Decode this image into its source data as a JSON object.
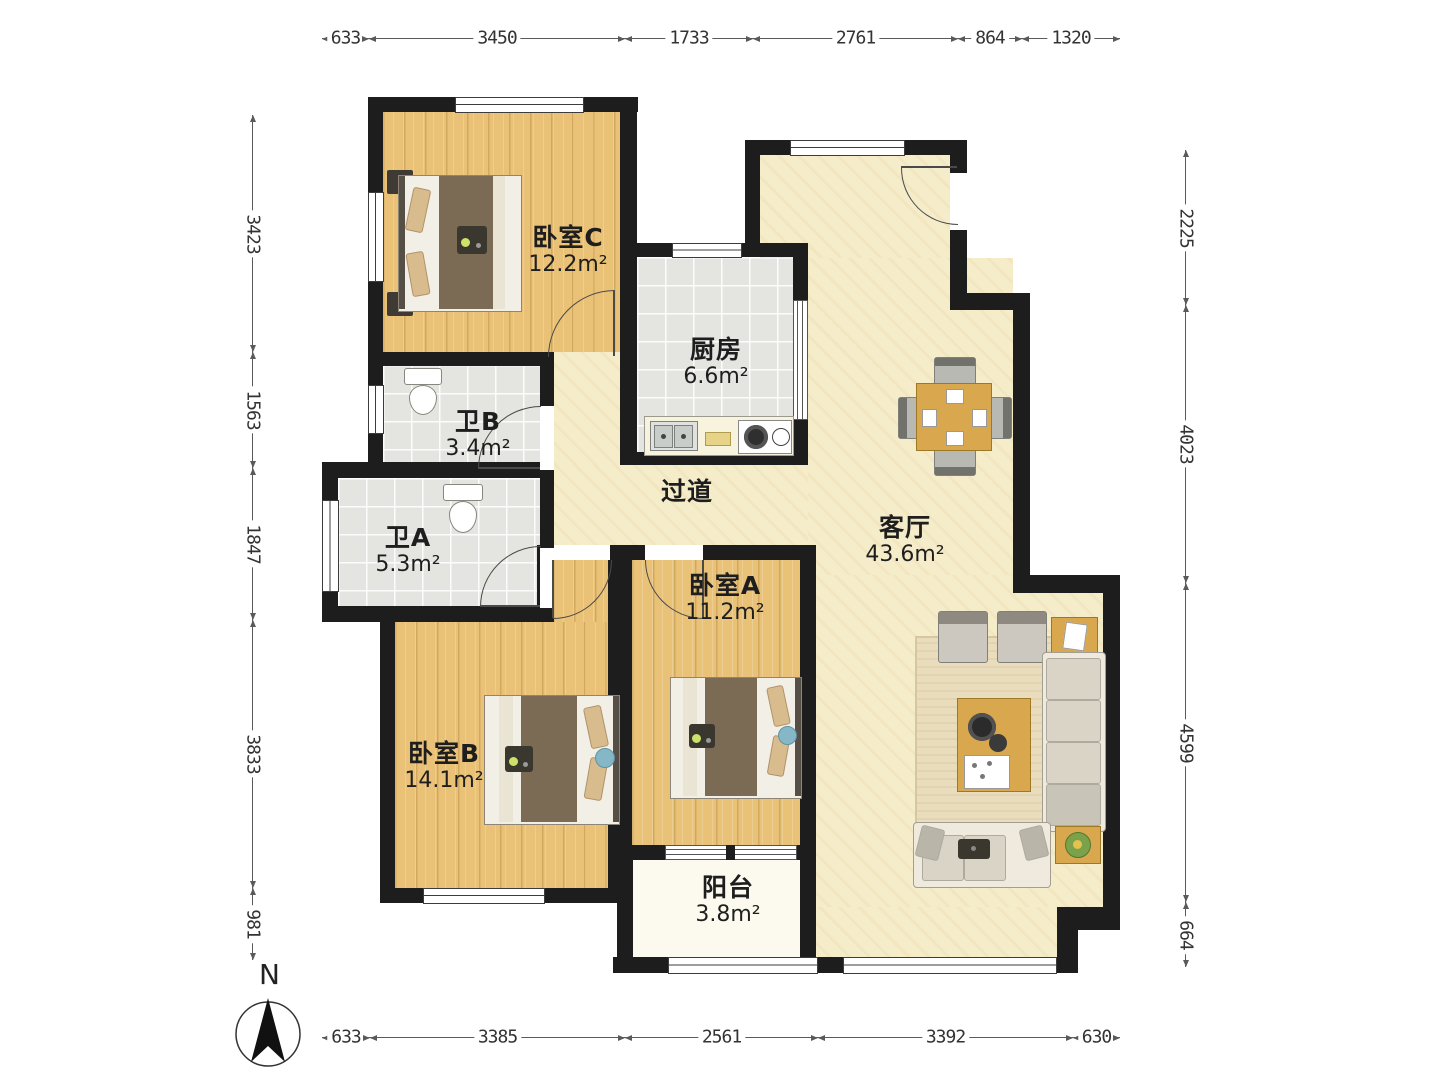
{
  "plan": {
    "north_label": "N",
    "rooms": [
      {
        "name": "卧室C",
        "area": "12.2m²"
      },
      {
        "name": "厨房",
        "area": "6.6m²"
      },
      {
        "name": "卫B",
        "area": "3.4m²"
      },
      {
        "name": "卫A",
        "area": "5.3m²"
      },
      {
        "name": "过道",
        "area": ""
      },
      {
        "name": "客厅",
        "area": "43.6m²"
      },
      {
        "name": "卧室A",
        "area": "11.2m²"
      },
      {
        "name": "卧室B",
        "area": "14.1m²"
      },
      {
        "name": "阳台",
        "area": "3.8m²"
      }
    ],
    "dimensions": {
      "top": [
        "633",
        "3450",
        "1733",
        "2761",
        "864",
        "1320"
      ],
      "bottom": [
        "633",
        "3385",
        "2561",
        "3392",
        "630"
      ],
      "left": [
        "3423",
        "1563",
        "1847",
        "3833",
        "981"
      ],
      "right": [
        "2225",
        "4023",
        "4599",
        "664"
      ]
    },
    "colors": {
      "wall": "#1d1d1d",
      "wood_floor": "#e9c277",
      "living_floor": "#f5ecca",
      "tile_floor": "#e4e5e1",
      "accent_wood": "#d9a84e"
    }
  }
}
